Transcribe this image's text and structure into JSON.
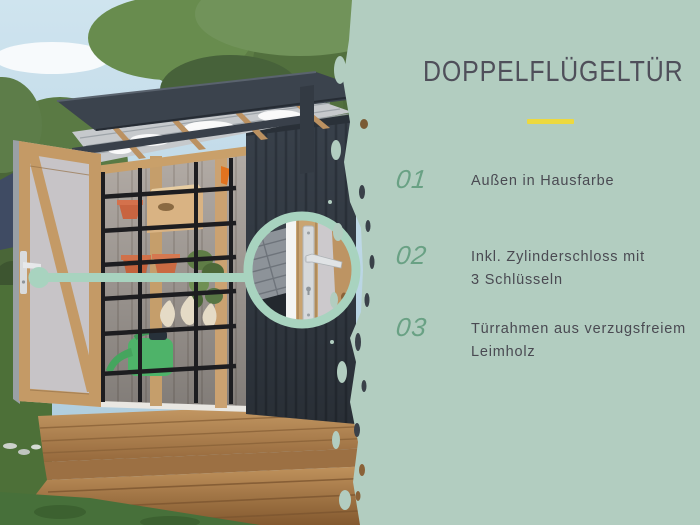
{
  "panel": {
    "background_color": "#B2CDC0",
    "title": "DOPPELFLÜGELTÜR",
    "title_color": "#4F4F5A",
    "divider_color": "#EDD93F",
    "feature_number_color": "#69A184",
    "feature_text_color": "#4A4A52",
    "features": [
      {
        "number": "01",
        "lines": [
          "Außen in Hausfarbe",
          ""
        ]
      },
      {
        "number": "02",
        "lines": [
          "Inkl. Zylinderschloss mit",
          "3 Schlüsseln"
        ]
      },
      {
        "number": "03",
        "lines": [
          "Türrahmen aus verzugsfreiem",
          "Leimholz"
        ]
      }
    ]
  },
  "photo": {
    "callout_accent_color": "#A8D3BF",
    "shed_color": "#39414B",
    "deck_color": "#B8875A"
  }
}
